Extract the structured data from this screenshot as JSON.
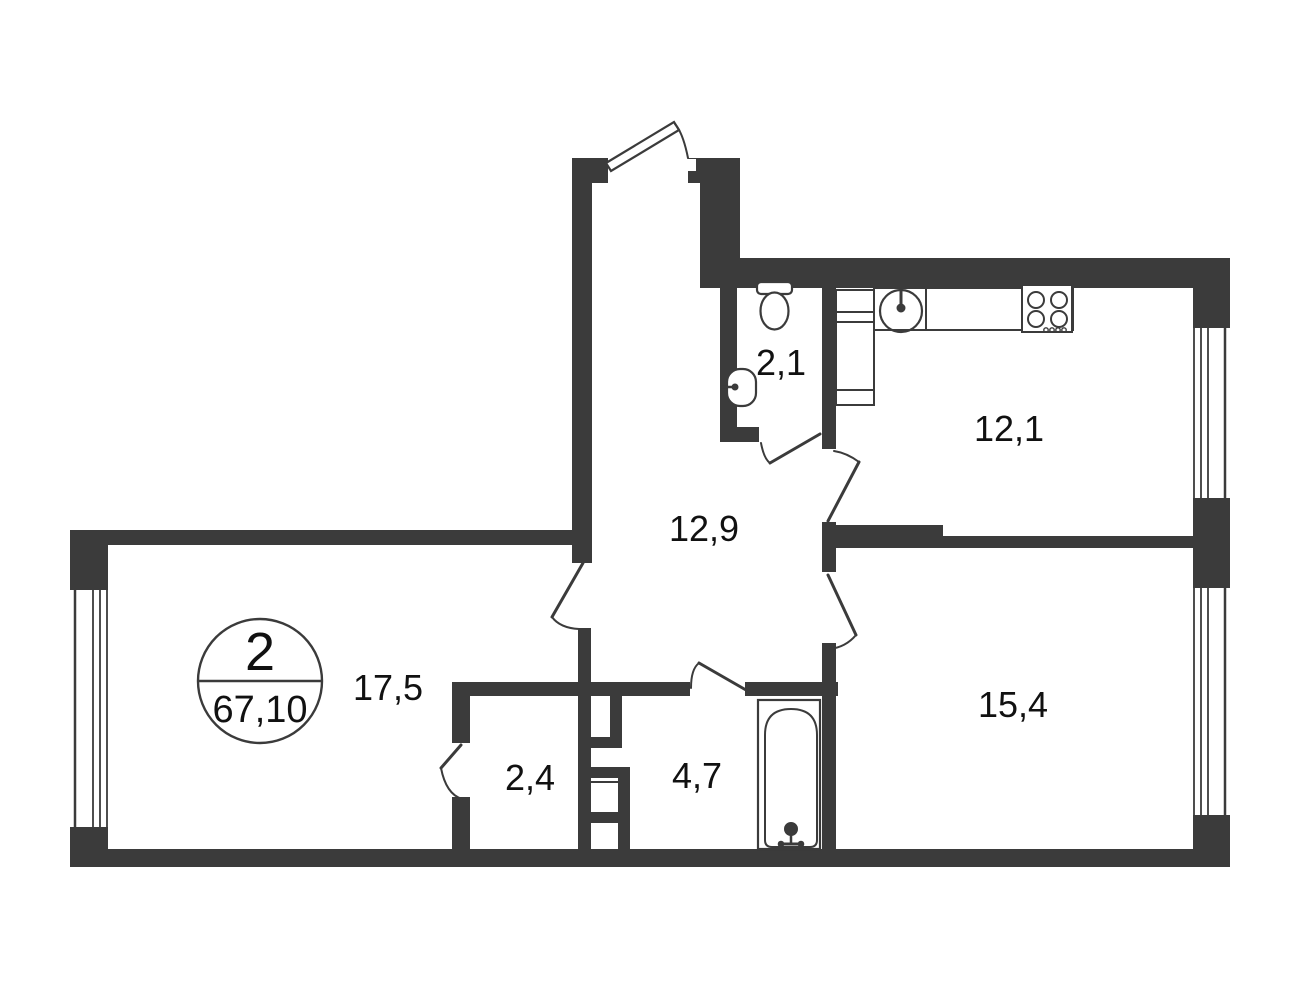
{
  "plan": {
    "summary": {
      "rooms_count": "2",
      "total_area": "67,10"
    },
    "rooms": [
      {
        "name": "toilet",
        "area": "2,1"
      },
      {
        "name": "kitchen",
        "area": "12,1"
      },
      {
        "name": "hallway",
        "area": "12,9"
      },
      {
        "name": "living-room",
        "area": "17,5"
      },
      {
        "name": "storage",
        "area": "2,4"
      },
      {
        "name": "bathroom",
        "area": "4,7"
      },
      {
        "name": "bedroom",
        "area": "15,4"
      }
    ],
    "colors": {
      "wall": "#3b3b3b",
      "text": "#111111",
      "background": "#ffffff"
    }
  }
}
